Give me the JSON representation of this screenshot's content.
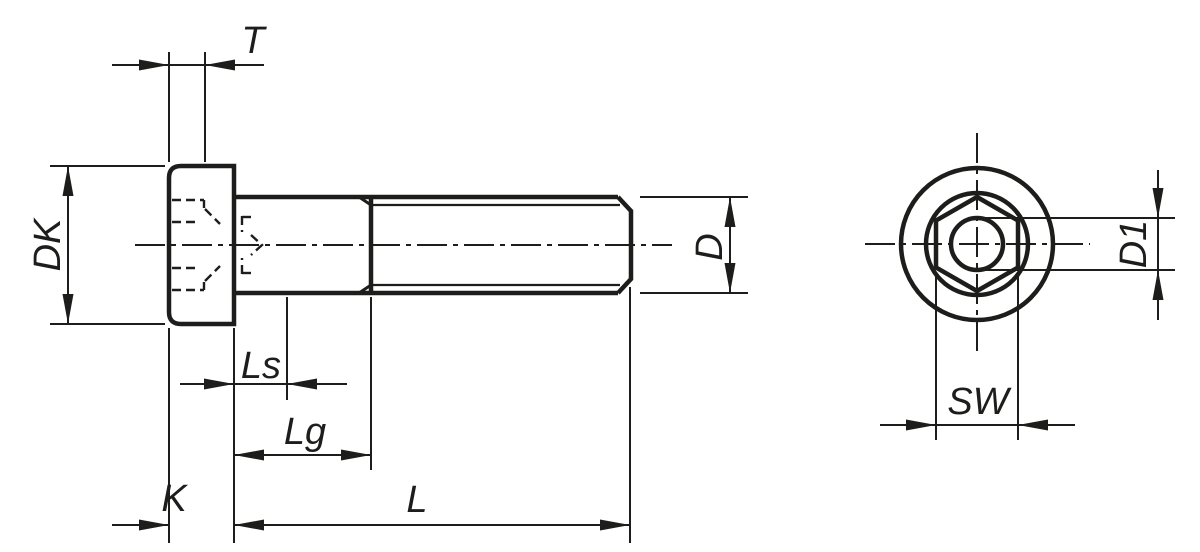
{
  "drawing": {
    "colors": {
      "line": "#1d1d1b",
      "background": "#ffffff"
    },
    "dims": {
      "t": "T",
      "dk": "DK",
      "d": "D",
      "ls": "Ls",
      "lg": "Lg",
      "k": "K",
      "l": "L",
      "d1": "D1",
      "sw": "SW"
    }
  }
}
